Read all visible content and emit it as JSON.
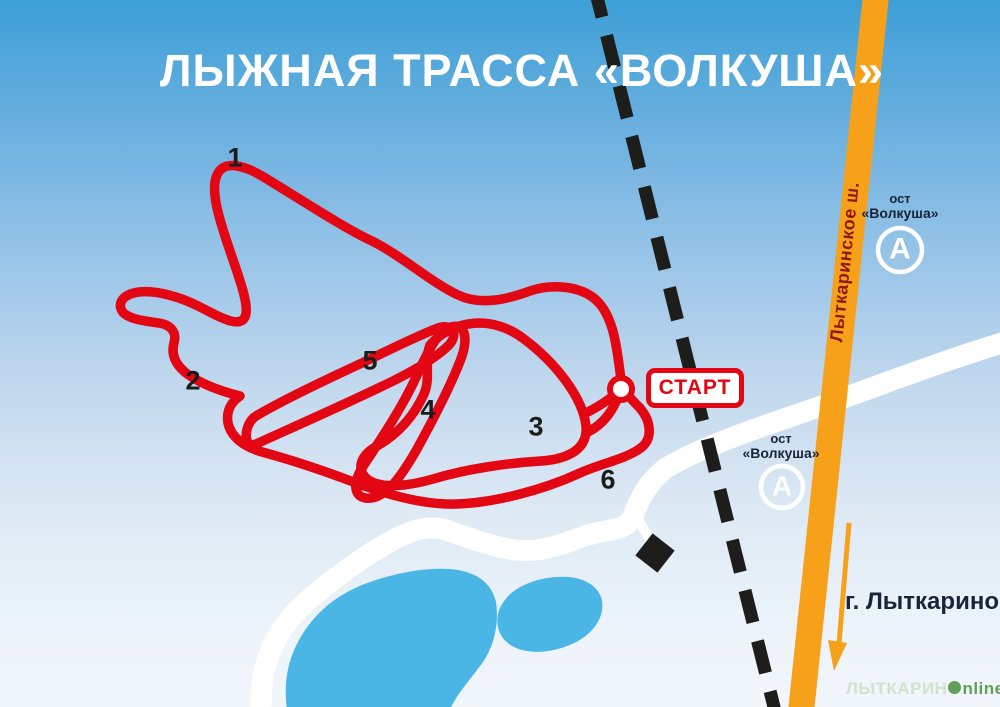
{
  "title": "ЛЫЖНАЯ ТРАССА «ВОЛКУША»",
  "trail": {
    "start_label": "СТАРТ",
    "checkpoints": [
      "1",
      "2",
      "3",
      "4",
      "5",
      "6"
    ]
  },
  "road": {
    "label": "Лыткаринское ш."
  },
  "bus_stops": [
    {
      "line1": "ост",
      "line2": "«Волкуша»",
      "symbol": "А"
    },
    {
      "line1": "ост",
      "line2": "«Волкуша»",
      "symbol": "А"
    }
  ],
  "direction": {
    "city": "г. Лыткарино"
  },
  "watermark": {
    "left": "ЛЫТКАРИН",
    "o": "o",
    "right": "nline"
  },
  "colors": {
    "trail_red": "#e30613",
    "road_orange": "#f7a11b",
    "lake_blue": "#49b6e6",
    "line_black": "#1d1d1b",
    "text_navy": "#1a2438",
    "road_label_dark_red": "#8f1a0d",
    "title_white": "#ffffff",
    "watermark_green": "#5f9f58"
  }
}
